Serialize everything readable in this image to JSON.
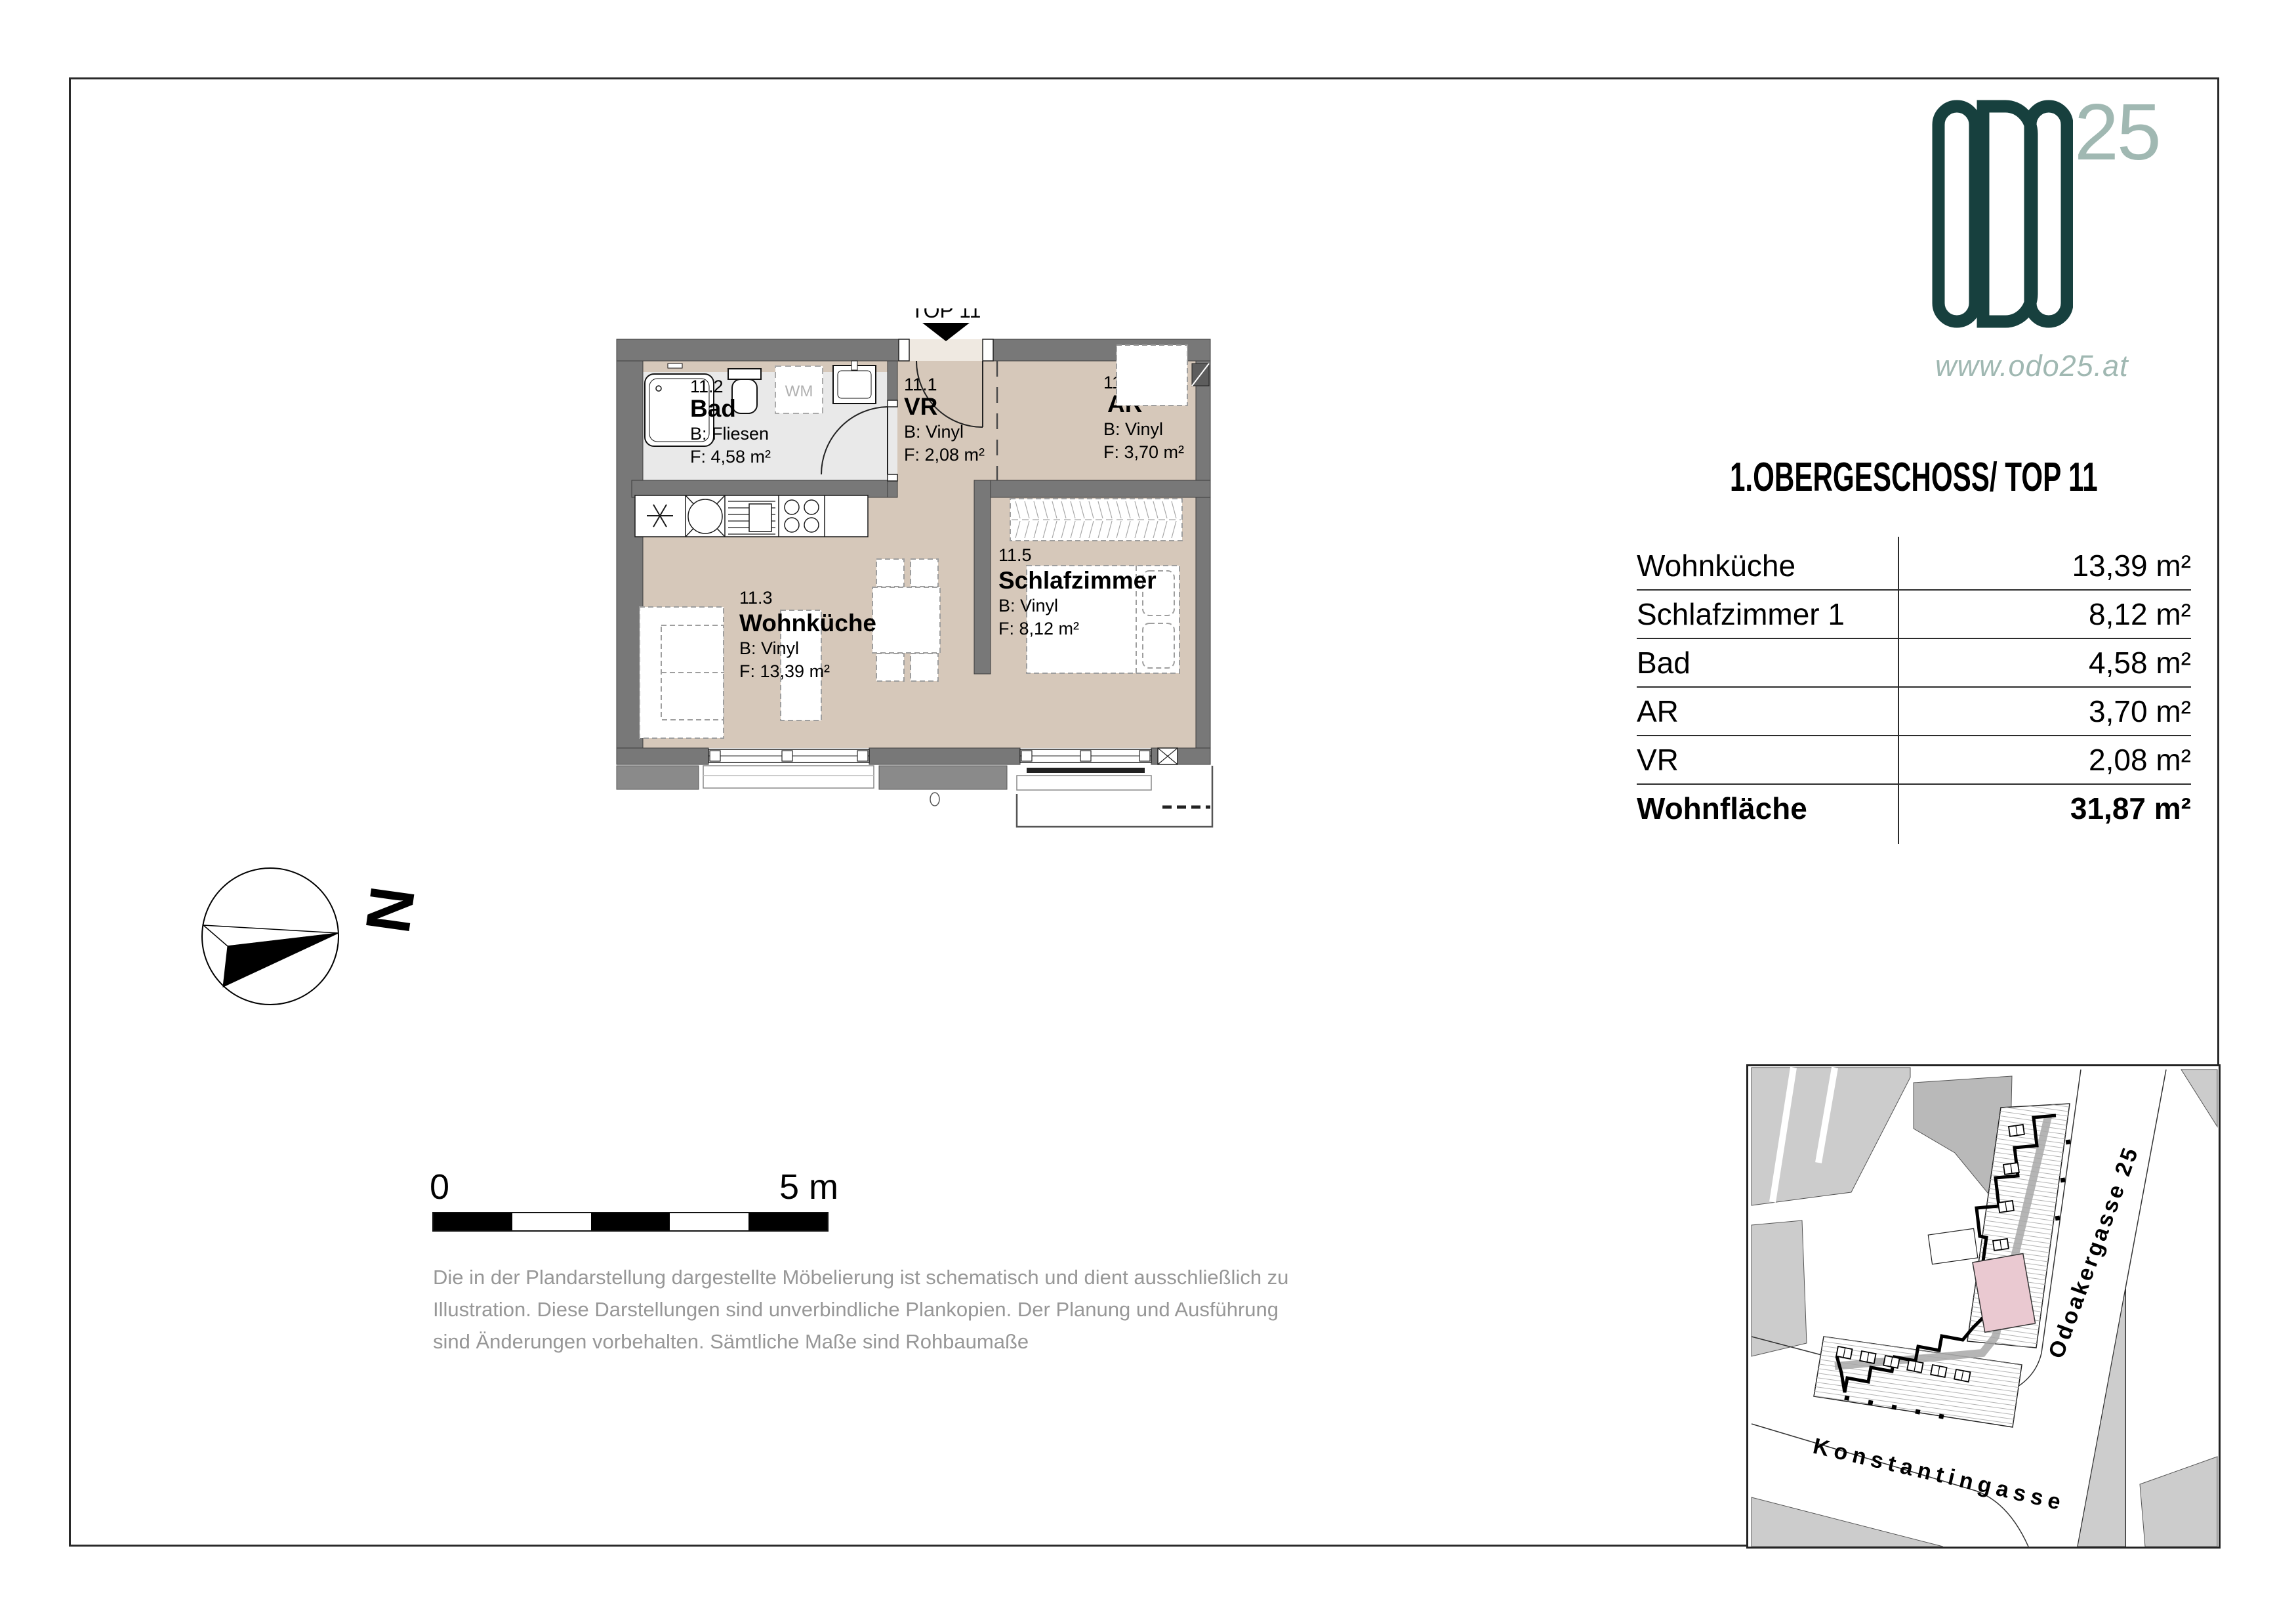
{
  "page": {
    "logo": {
      "brand": "ODO",
      "superscript": "25",
      "website": "www.odo25.at"
    },
    "title": "1.OBERGESCHOSS/ TOP 11",
    "area_table": {
      "rows": [
        {
          "label": "Wohnküche",
          "value": "13,39 m²"
        },
        {
          "label": "Schlafzimmer 1",
          "value": "8,12 m²"
        },
        {
          "label": "Bad",
          "value": "4,58 m²"
        },
        {
          "label": "AR",
          "value": "3,70 m²"
        },
        {
          "label": "VR",
          "value": "2,08 m²"
        }
      ],
      "total": {
        "label": "Wohnfläche",
        "value": "31,87 m²"
      }
    },
    "floorplan": {
      "entrance_label": "TOP 11",
      "appliance_label": "WM",
      "rooms": {
        "vr": {
          "number": "11.1",
          "name": "VR",
          "floor": "B: Vinyl",
          "area": "F: 2,08 m²"
        },
        "bad": {
          "number": "11.2",
          "name": "Bad",
          "floor": "B: Fliesen",
          "area": "F: 4,58 m²"
        },
        "wohnkueche": {
          "number": "11.3",
          "name": "Wohnküche",
          "floor": "B: Vinyl",
          "area": "F: 13,39 m²"
        },
        "ar": {
          "number": "11.4",
          "name": "AR",
          "floor": "B: Vinyl",
          "area": "F: 3,70 m²"
        },
        "schlafzimmer": {
          "number": "11.5",
          "name": "Schlafzimmer",
          "floor": "B: Vinyl",
          "area": "F: 8,12 m²"
        }
      }
    },
    "compass": {
      "north_label": "N"
    },
    "scalebar": {
      "start": "0",
      "end": "5 m"
    },
    "disclaimer": [
      "Die in der Plandarstellung dargestellte Möbelierung ist schematisch und dient ausschließlich zu",
      "Illustration. Diese Darstellungen sind unverbindliche Plankopien. Der Planung und Ausführung",
      "sind Änderungen vorbehalten. Sämtliche Maße sind Rohbaumaße"
    ],
    "sitemap": {
      "street_bottom": "Konstantingasse",
      "street_right": "Odoakergasse 25"
    },
    "colors": {
      "brand_dark": "#17403e",
      "brand_light": "#a0b8b2",
      "floor_beige": "#d6c8ba",
      "floor_bath": "#e9e9e9",
      "wall_gray": "#787878",
      "highlight_pink": "#eac9d1"
    }
  }
}
